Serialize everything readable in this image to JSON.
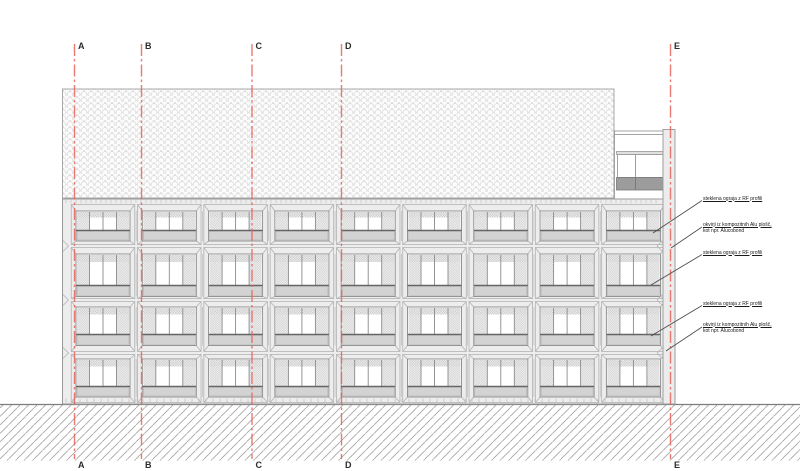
{
  "grid": {
    "labels": [
      "A",
      "B",
      "C",
      "D",
      "E"
    ]
  },
  "annotations": [
    {
      "line1": "steklena ograja z RF profili",
      "line2": ""
    },
    {
      "line1": "okvirji iz kompozitnih Alu plošč,",
      "line2": "kot npr. Alucobond"
    },
    {
      "line1": "steklena ograja z RF profili",
      "line2": ""
    },
    {
      "line1": "steklena ograja z RF profili",
      "line2": ""
    },
    {
      "line1": "okvirji iz kompozitnih Alu plošč,",
      "line2": "kot npr. Alucobond"
    }
  ],
  "building": {
    "floors": 4,
    "window_bays_per_floor": 9
  },
  "colors": {
    "grid_line": "#e7645b",
    "drawing_line": "#9a9a9a",
    "cell_line": "#b3b3b3",
    "window_line": "#8a8a8a",
    "facade_fill": "#ededed",
    "spandrel_fill": "#d3d3d3",
    "dark_panel_fill": "#9c9c9c",
    "roof_fill": "#f7f7f7"
  }
}
